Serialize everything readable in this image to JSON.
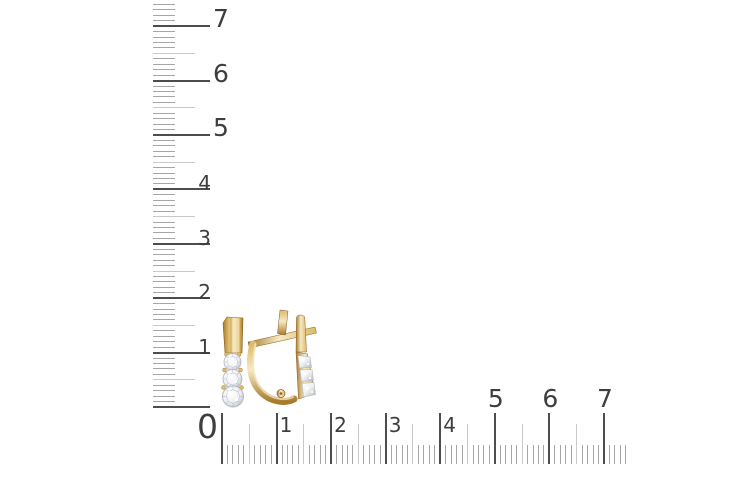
{
  "canvas": {
    "width": 750,
    "height": 500,
    "background": "#ffffff"
  },
  "rulers": {
    "origin_label": "0",
    "vertical": {
      "labels": [
        "1",
        "2",
        "3",
        "4",
        "5",
        "6",
        "7"
      ],
      "range_start": 0,
      "range_end": 7
    },
    "horizontal": {
      "labels": [
        "1",
        "2",
        "3",
        "4",
        "5",
        "6",
        "7"
      ],
      "range_start": 0,
      "range_end": 7
    }
  },
  "colors": {
    "background": "#ffffff",
    "tick_major": "#4d4d4d",
    "tick_half": "#c9c9c9",
    "tick_minor": "#a6a6a6",
    "label_text": "#3e3e3e",
    "gold_light": "#f5e9c2",
    "gold_mid": "#ddb968",
    "gold_dark": "#a87b2d",
    "gold_outline": "#8a5f1e",
    "diamond_light": "#ffffff",
    "diamond_mid": "#eef0f3",
    "diamond_shadow": "#b3b6c0"
  },
  "product": {
    "items": [
      {
        "name": "earring-front-view"
      },
      {
        "name": "earring-side-view"
      }
    ]
  }
}
